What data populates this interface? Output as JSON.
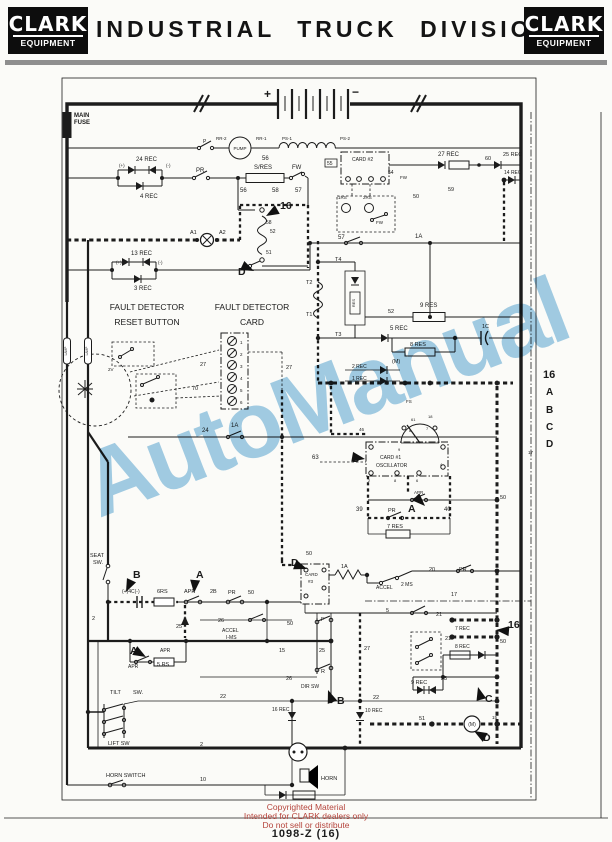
{
  "header": {
    "logo_top": "CLARK",
    "logo_bottom": "EQUIPMENT",
    "title": "INDUSTRIAL TRUCK DIVISION"
  },
  "watermark": {
    "text": "AutoManual",
    "color": "#8cc2e2"
  },
  "footer": {
    "line1": "Copyrighted Material",
    "line2": "Intended for CLARK dealers only",
    "line3": "Do not sell or distribute",
    "doc_number": "1098-Z   (16)"
  },
  "schematic": {
    "labels": [
      {
        "t": "MAIN",
        "x": 74,
        "y": 117,
        "b": 1
      },
      {
        "t": "FUSE",
        "x": 74,
        "y": 124,
        "b": 1
      },
      {
        "t": "+",
        "x": 264,
        "y": 98,
        "s": 12,
        "b": 1
      },
      {
        "t": "−",
        "x": 352,
        "y": 96,
        "s": 12,
        "b": 1
      },
      {
        "t": "P",
        "x": 203,
        "y": 143,
        "s": 5
      },
      {
        "t": "RR-2",
        "x": 216,
        "y": 140,
        "s": 4.5
      },
      {
        "t": "PUMP",
        "x": 240,
        "y": 150,
        "s": 4.5,
        "a": "m"
      },
      {
        "t": "RR-1",
        "x": 256,
        "y": 140,
        "s": 4.5
      },
      {
        "t": "PS-1",
        "x": 282,
        "y": 140,
        "s": 4.5
      },
      {
        "t": "PS-2",
        "x": 340,
        "y": 140,
        "s": 4.5
      },
      {
        "t": "56",
        "x": 262,
        "y": 160,
        "s": 6
      },
      {
        "t": "24 REC",
        "x": 136,
        "y": 161
      },
      {
        "t": "(+)",
        "x": 119,
        "y": 167,
        "s": 4.5
      },
      {
        "t": "(-)",
        "x": 166,
        "y": 167,
        "s": 4.5
      },
      {
        "t": "4 REC",
        "x": 140,
        "y": 198
      },
      {
        "t": "PR",
        "x": 196,
        "y": 172
      },
      {
        "t": "S/RES",
        "x": 254,
        "y": 169
      },
      {
        "t": "FW",
        "x": 292,
        "y": 169
      },
      {
        "t": "56",
        "x": 240,
        "y": 192
      },
      {
        "t": "58",
        "x": 272,
        "y": 192
      },
      {
        "t": "57",
        "x": 295,
        "y": 192
      },
      {
        "t": "58",
        "x": 266,
        "y": 224,
        "s": 5
      },
      {
        "t": "52",
        "x": 270,
        "y": 233,
        "s": 5
      },
      {
        "t": "51",
        "x": 266,
        "y": 254,
        "s": 5
      },
      {
        "t": "A1",
        "x": 190,
        "y": 234,
        "s": 5.5
      },
      {
        "t": "A2",
        "x": 219,
        "y": 234,
        "s": 5.5
      },
      {
        "t": "13 REC",
        "x": 131,
        "y": 255
      },
      {
        "t": "(+)",
        "x": 116,
        "y": 264,
        "s": 4.5
      },
      {
        "t": "(-)",
        "x": 158,
        "y": 264,
        "s": 4.5
      },
      {
        "t": "3 REC",
        "x": 134,
        "y": 290
      },
      {
        "t": "55",
        "x": 327,
        "y": 165,
        "s": 5
      },
      {
        "t": "CARD #2",
        "x": 352,
        "y": 161,
        "s": 5
      },
      {
        "t": "27 REC",
        "x": 438,
        "y": 156
      },
      {
        "t": "60",
        "x": 485,
        "y": 160,
        "s": 5.5
      },
      {
        "t": "25 REC",
        "x": 503,
        "y": 156,
        "s": 5.5
      },
      {
        "t": "14 REC",
        "x": 504,
        "y": 174,
        "s": 5
      },
      {
        "t": "54",
        "x": 388,
        "y": 174,
        "s": 5
      },
      {
        "t": "FW",
        "x": 400,
        "y": 179,
        "s": 4.5
      },
      {
        "t": "59",
        "x": 448,
        "y": 191,
        "s": 5.5
      },
      {
        "t": "50",
        "x": 413,
        "y": 198,
        "s": 5.5
      },
      {
        "t": "1RS",
        "x": 338,
        "y": 199,
        "s": 4.5
      },
      {
        "t": "2RS",
        "x": 363,
        "y": 199,
        "s": 4.5
      },
      {
        "t": "FW",
        "x": 376,
        "y": 224,
        "s": 4.5
      },
      {
        "t": "57",
        "x": 338,
        "y": 239,
        "s": 6
      },
      {
        "t": "1A",
        "x": 415,
        "y": 238,
        "s": 6
      },
      {
        "t": "T4",
        "x": 335,
        "y": 261,
        "s": 5.5
      },
      {
        "t": "T2",
        "x": 306,
        "y": 284,
        "s": 5.5
      },
      {
        "t": "T1",
        "x": 306,
        "y": 316,
        "s": 5.5
      },
      {
        "t": "T3",
        "x": 335,
        "y": 336,
        "s": 5.5
      },
      {
        "t": "RES",
        "x": 355,
        "y": 303,
        "s": 4,
        "a": "m",
        "r": -90
      },
      {
        "t": "52",
        "x": 388,
        "y": 313,
        "s": 5.5
      },
      {
        "t": "9 RES",
        "x": 420,
        "y": 307
      },
      {
        "t": "5 REC",
        "x": 390,
        "y": 330
      },
      {
        "t": "1C",
        "x": 482,
        "y": 328,
        "s": 5.5
      },
      {
        "t": "8 RES",
        "x": 410,
        "y": 346,
        "s": 5.5
      },
      {
        "t": "(M)",
        "x": 392,
        "y": 363,
        "s": 5.5
      },
      {
        "t": "FAULT DETECTOR",
        "x": 147,
        "y": 310,
        "s": 8.5,
        "a": "m"
      },
      {
        "t": "RESET BUTTON",
        "x": 147,
        "y": 325,
        "s": 8.5,
        "a": "m"
      },
      {
        "t": "FAULT DETECTOR",
        "x": 252,
        "y": 310,
        "s": 8.5,
        "a": "m"
      },
      {
        "t": "CARD",
        "x": 252,
        "y": 325,
        "s": 8.5,
        "a": "m"
      },
      {
        "t": "1",
        "x": 240,
        "y": 344,
        "s": 4.5
      },
      {
        "t": "2",
        "x": 240,
        "y": 356,
        "s": 4.5
      },
      {
        "t": "3",
        "x": 240,
        "y": 368,
        "s": 4.5
      },
      {
        "t": "4",
        "x": 240,
        "y": 380,
        "s": 4.5
      },
      {
        "t": "5",
        "x": 240,
        "y": 392,
        "s": 4.5
      },
      {
        "t": "6",
        "x": 240,
        "y": 404,
        "s": 4.5
      },
      {
        "t": "27",
        "x": 200,
        "y": 366,
        "s": 5.5
      },
      {
        "t": "70",
        "x": 192,
        "y": 390,
        "s": 5.5
      },
      {
        "t": "27",
        "x": 286,
        "y": 369,
        "s": 5.5
      },
      {
        "t": "2V",
        "x": 108,
        "y": 371,
        "s": 4.5
      },
      {
        "t": "LAMP",
        "x": 67,
        "y": 351,
        "s": 3.2,
        "a": "m",
        "r": -90
      },
      {
        "t": "LAMP",
        "x": 88,
        "y": 351,
        "s": 3.2,
        "a": "m",
        "r": -90
      },
      {
        "t": "24",
        "x": 202,
        "y": 432,
        "s": 6
      },
      {
        "t": "1A",
        "x": 231,
        "y": 427,
        "s": 6
      },
      {
        "t": "2 REC",
        "x": 352,
        "y": 368,
        "s": 5
      },
      {
        "t": "1 REC",
        "x": 352,
        "y": 380,
        "s": 5
      },
      {
        "t": "63",
        "x": 312,
        "y": 459,
        "s": 6
      },
      {
        "t": "CARD #1",
        "x": 380,
        "y": 459,
        "s": 5
      },
      {
        "t": "OSCILLATOR",
        "x": 376,
        "y": 467,
        "s": 5
      },
      {
        "t": "FS",
        "x": 406,
        "y": 403,
        "s": 4.5
      },
      {
        "t": "61",
        "x": 411,
        "y": 421,
        "s": 4
      },
      {
        "t": "18",
        "x": 428,
        "y": 418,
        "s": 4
      },
      {
        "t": "8",
        "x": 409,
        "y": 432,
        "s": 4
      },
      {
        "t": "7",
        "x": 426,
        "y": 430,
        "s": 4
      },
      {
        "t": "46",
        "x": 359,
        "y": 431,
        "s": 4.5
      },
      {
        "t": "9",
        "x": 398,
        "y": 451,
        "s": 4
      },
      {
        "t": "2",
        "x": 368,
        "y": 482,
        "s": 4
      },
      {
        "t": "8",
        "x": 394,
        "y": 482,
        "s": 4
      },
      {
        "t": "6",
        "x": 416,
        "y": 482,
        "s": 4
      },
      {
        "t": "4",
        "x": 440,
        "y": 466,
        "s": 4
      },
      {
        "t": "APR",
        "x": 414,
        "y": 494,
        "s": 4.5
      },
      {
        "t": "39",
        "x": 356,
        "y": 511,
        "s": 6
      },
      {
        "t": "PR",
        "x": 388,
        "y": 512,
        "s": 5.5
      },
      {
        "t": "40",
        "x": 444,
        "y": 511,
        "s": 6
      },
      {
        "t": "7 RES",
        "x": 387,
        "y": 528,
        "s": 5.5
      },
      {
        "t": "50",
        "x": 500,
        "y": 499,
        "s": 5.5
      },
      {
        "t": "17",
        "x": 528,
        "y": 454,
        "s": 4.5
      },
      {
        "t": "SEAT",
        "x": 90,
        "y": 557,
        "s": 5.5
      },
      {
        "t": "SW.",
        "x": 93,
        "y": 564,
        "s": 5.5
      },
      {
        "t": "(+)4C(-)",
        "x": 122,
        "y": 593,
        "s": 5
      },
      {
        "t": "6RS",
        "x": 157,
        "y": 593,
        "s": 5.5
      },
      {
        "t": "APR",
        "x": 184,
        "y": 593,
        "s": 5.5
      },
      {
        "t": "2B",
        "x": 210,
        "y": 593,
        "s": 5.5
      },
      {
        "t": "PR",
        "x": 228,
        "y": 594,
        "s": 5.5
      },
      {
        "t": "50",
        "x": 248,
        "y": 594,
        "s": 5.5
      },
      {
        "t": "26",
        "x": 218,
        "y": 622,
        "s": 5.5
      },
      {
        "t": "25",
        "x": 176,
        "y": 628,
        "s": 5.5
      },
      {
        "t": "ACCEL",
        "x": 222,
        "y": 632,
        "s": 5
      },
      {
        "t": "I-MS",
        "x": 226,
        "y": 639,
        "s": 5
      },
      {
        "t": "2",
        "x": 92,
        "y": 620,
        "s": 5.5
      },
      {
        "t": "15",
        "x": 279,
        "y": 652,
        "s": 5.5
      },
      {
        "t": "APR",
        "x": 160,
        "y": 652,
        "s": 5
      },
      {
        "t": "APR",
        "x": 128,
        "y": 668,
        "s": 5
      },
      {
        "t": "5 RS",
        "x": 157,
        "y": 666,
        "s": 5.5
      },
      {
        "t": "26",
        "x": 286,
        "y": 680,
        "s": 5.5
      },
      {
        "t": "CARD",
        "x": 305,
        "y": 576,
        "s": 4.5
      },
      {
        "t": "#3",
        "x": 308,
        "y": 583,
        "s": 4.5
      },
      {
        "t": "1A",
        "x": 341,
        "y": 568,
        "s": 5.5
      },
      {
        "t": "ACCEL",
        "x": 376,
        "y": 589,
        "s": 5
      },
      {
        "t": "2 MS",
        "x": 401,
        "y": 586,
        "s": 5
      },
      {
        "t": "20",
        "x": 429,
        "y": 571,
        "s": 5.5
      },
      {
        "t": "PR",
        "x": 459,
        "y": 571,
        "s": 5.5
      },
      {
        "t": "17",
        "x": 451,
        "y": 596,
        "s": 5.5
      },
      {
        "t": "50",
        "x": 306,
        "y": 555,
        "s": 5.5
      },
      {
        "t": "5",
        "x": 386,
        "y": 612,
        "s": 5.5
      },
      {
        "t": "21",
        "x": 436,
        "y": 616,
        "s": 5.5
      },
      {
        "t": "7 REC",
        "x": 455,
        "y": 630,
        "s": 5
      },
      {
        "t": "50",
        "x": 500,
        "y": 643,
        "s": 5.5
      },
      {
        "t": "27",
        "x": 364,
        "y": 650,
        "s": 5.5
      },
      {
        "t": "21",
        "x": 445,
        "y": 640,
        "s": 5.5
      },
      {
        "t": "8 REC",
        "x": 455,
        "y": 648,
        "s": 5
      },
      {
        "t": "23",
        "x": 441,
        "y": 680,
        "s": 5.5
      },
      {
        "t": "9 REC",
        "x": 411,
        "y": 684,
        "s": 5.5
      },
      {
        "t": "50",
        "x": 287,
        "y": 625,
        "s": 5.5
      },
      {
        "t": "F",
        "x": 321,
        "y": 621,
        "s": 5.5
      },
      {
        "t": "25",
        "x": 319,
        "y": 652,
        "s": 5.5
      },
      {
        "t": "R",
        "x": 321,
        "y": 673,
        "s": 5.5
      },
      {
        "t": "DIR SW",
        "x": 301,
        "y": 688,
        "s": 5
      },
      {
        "t": "22",
        "x": 373,
        "y": 699,
        "s": 5.5
      },
      {
        "t": "16 REC",
        "x": 272,
        "y": 711,
        "s": 5
      },
      {
        "t": "10 REC",
        "x": 365,
        "y": 712,
        "s": 5
      },
      {
        "t": "TILT",
        "x": 110,
        "y": 694,
        "s": 5.5
      },
      {
        "t": "SW.",
        "x": 133,
        "y": 694,
        "s": 5.5
      },
      {
        "t": "LIFT SW",
        "x": 108,
        "y": 745,
        "s": 5.5
      },
      {
        "t": "22",
        "x": 220,
        "y": 698,
        "s": 5.5
      },
      {
        "t": "2",
        "x": 200,
        "y": 746,
        "s": 5.5
      },
      {
        "t": "HORN SWITCH",
        "x": 106,
        "y": 777,
        "s": 5.5
      },
      {
        "t": "10",
        "x": 200,
        "y": 781,
        "s": 5.5
      },
      {
        "t": "HORN",
        "x": 321,
        "y": 780,
        "s": 5.5
      },
      {
        "t": "51",
        "x": 419,
        "y": 720,
        "s": 5.5
      },
      {
        "t": "(M)",
        "x": 472,
        "y": 726,
        "s": 5,
        "a": "m"
      },
      {
        "t": "15",
        "x": 492,
        "y": 719,
        "s": 4.5
      },
      {
        "t": "16",
        "x": 543,
        "y": 378,
        "s": 11,
        "b": 1
      },
      {
        "t": "A",
        "x": 546,
        "y": 395,
        "s": 10,
        "b": 1
      },
      {
        "t": "B",
        "x": 546,
        "y": 413,
        "s": 10,
        "b": 1
      },
      {
        "t": "C",
        "x": 546,
        "y": 430,
        "s": 10,
        "b": 1
      },
      {
        "t": "D",
        "x": 546,
        "y": 447,
        "s": 10,
        "b": 1
      }
    ],
    "markers": [
      {
        "t": "16",
        "x": 280,
        "y": 209,
        "ax": 266,
        "ay": 216,
        "rot": 150
      },
      {
        "t": "D",
        "x": 238,
        "y": 275,
        "ax": 254,
        "ay": 271,
        "rot": 25
      },
      {
        "t": "D",
        "x": 352,
        "y": 462,
        "ax": 365,
        "ay": 459,
        "rot": 10
      },
      {
        "t": "A",
        "x": 408,
        "y": 512,
        "ax": 425,
        "ay": 506,
        "rot": 45
      },
      {
        "t": "B",
        "x": 133,
        "y": 578,
        "ax": 126,
        "ay": 592,
        "rot": 115
      },
      {
        "t": "A",
        "x": 196,
        "y": 578,
        "ax": 194,
        "ay": 593,
        "rot": 95
      },
      {
        "t": "A",
        "x": 130,
        "y": 654,
        "ax": 146,
        "ay": 657,
        "rot": 30
      },
      {
        "t": "D",
        "x": 291,
        "y": 566,
        "ax": 307,
        "ay": 569,
        "rot": 20
      },
      {
        "t": "B",
        "x": 337,
        "y": 704,
        "ax": 328,
        "ay": 690,
        "rot": 250
      },
      {
        "t": "C",
        "x": 485,
        "y": 702,
        "ax": 478,
        "ay": 687,
        "rot": 255
      },
      {
        "t": "D",
        "x": 483,
        "y": 741,
        "ax": 474,
        "ay": 731,
        "rot": 210
      },
      {
        "t": "16",
        "x": 508,
        "y": 628,
        "ax": 496,
        "ay": 630,
        "rot": 185
      }
    ]
  }
}
